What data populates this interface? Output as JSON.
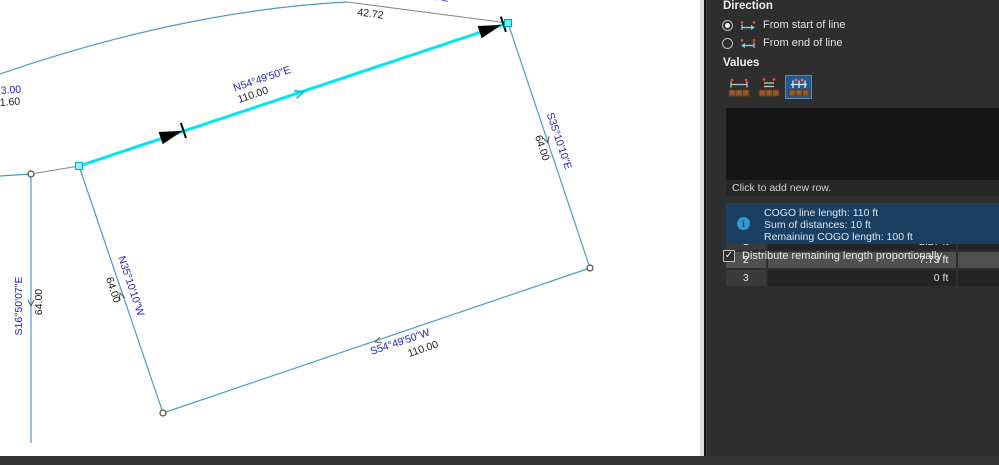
{
  "colors": {
    "cogo_highlight_cyan": "#00e6f2",
    "parcel_line_blue": "#4a9cc9",
    "bearing_label_blue": "#2323cc",
    "selection_blue": "#215a92",
    "info_box_blue": "#1b3f60",
    "panel_bg": "#2e2e2e"
  },
  "map": {
    "labels": {
      "cogo_bearing": "N54°49'50\"E",
      "cogo_distance": "110.00",
      "east_bearing": "S35°10'10\"E",
      "east_distance": "64.00",
      "south_bearing": "S54°49'50\"W",
      "south_distance": "110.00",
      "west_bearing": "N35°10'10\"W",
      "west_distance": "64.00",
      "farwest_bearing": "S16°50'07\"E",
      "farwest_distance": "64.00",
      "north_distance": "42.72",
      "north_bearing_clipped": "…0'01\"E",
      "left_clipped_blue": "3.00",
      "left_clipped_black": "1.60"
    }
  },
  "panel": {
    "direction": {
      "title": "Direction",
      "options": [
        {
          "label": "From start of line",
          "selected": true
        },
        {
          "label": "From end of line",
          "selected": false
        }
      ]
    },
    "values_title": "Values",
    "table": {
      "columns": [
        "#",
        "Distance",
        "Repetition"
      ],
      "rows": [
        {
          "num": "1",
          "distance": "2.27 ft",
          "selected": false
        },
        {
          "num": "2",
          "distance": "7.73 ft",
          "selected": true
        },
        {
          "num": "3",
          "distance": "0 ft",
          "selected": false
        }
      ],
      "add_row_hint": "Click to add new row."
    },
    "info": {
      "line1": "COGO line length: 110 ft",
      "line2": "Sum of distances: 10 ft",
      "line3": "Remaining COGO length: 100 ft"
    },
    "distribute_checkbox": {
      "label": "Distribute remaining length proportionally",
      "checked": true
    },
    "checkmark": "✓",
    "info_icon_glyph": "i"
  }
}
